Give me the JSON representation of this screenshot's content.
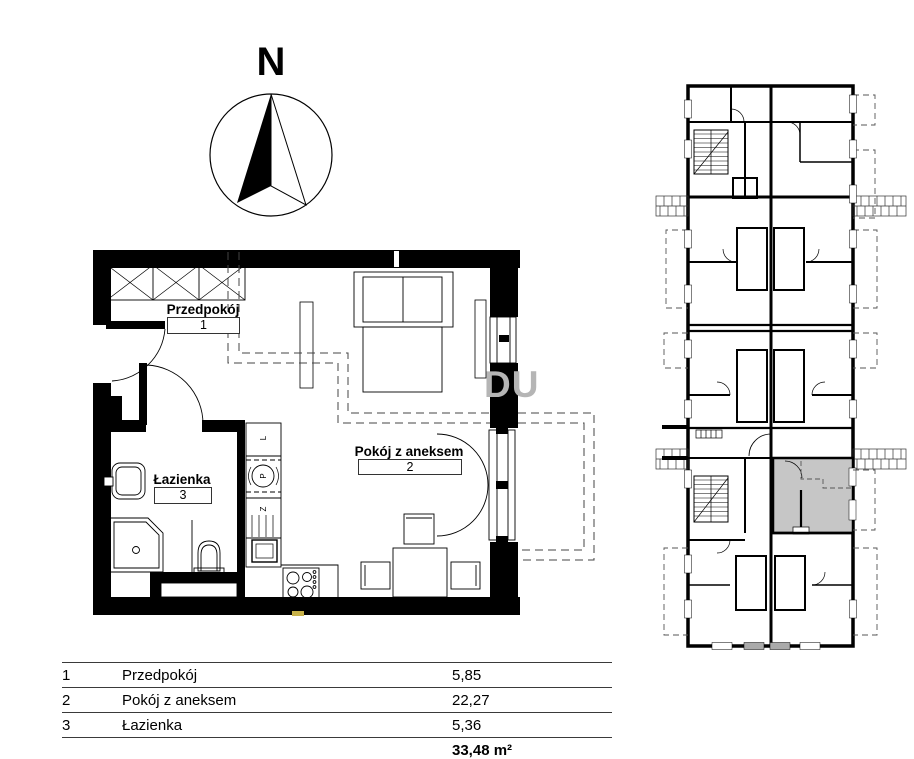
{
  "compass": {
    "north_label": "N"
  },
  "watermark": {
    "text": "DU"
  },
  "floor_plan": {
    "rooms": [
      {
        "number": "1",
        "name": "Przedpokój"
      },
      {
        "number": "2",
        "name": "Pokój z aneksem"
      },
      {
        "number": "3",
        "name": "Łazienka"
      }
    ],
    "kitchen_fixture_labels": [
      {
        "label": "L"
      },
      {
        "label": "P"
      },
      {
        "label": "Z"
      }
    ]
  },
  "area_table": {
    "rows": [
      {
        "no": "1",
        "name": "Przedpokój",
        "area": "5,85"
      },
      {
        "no": "2",
        "name": "Pokój z aneksem",
        "area": "22,27"
      },
      {
        "no": "3",
        "name": "Łazienka",
        "area": "5,36"
      }
    ],
    "total_area": "33,48 m²"
  },
  "colors": {
    "wall": "#000000",
    "highlight_unit": "#c6c6c6",
    "watermark_gray": "#b5b5b5",
    "utility_marker_yellow": "#c8b24a"
  }
}
